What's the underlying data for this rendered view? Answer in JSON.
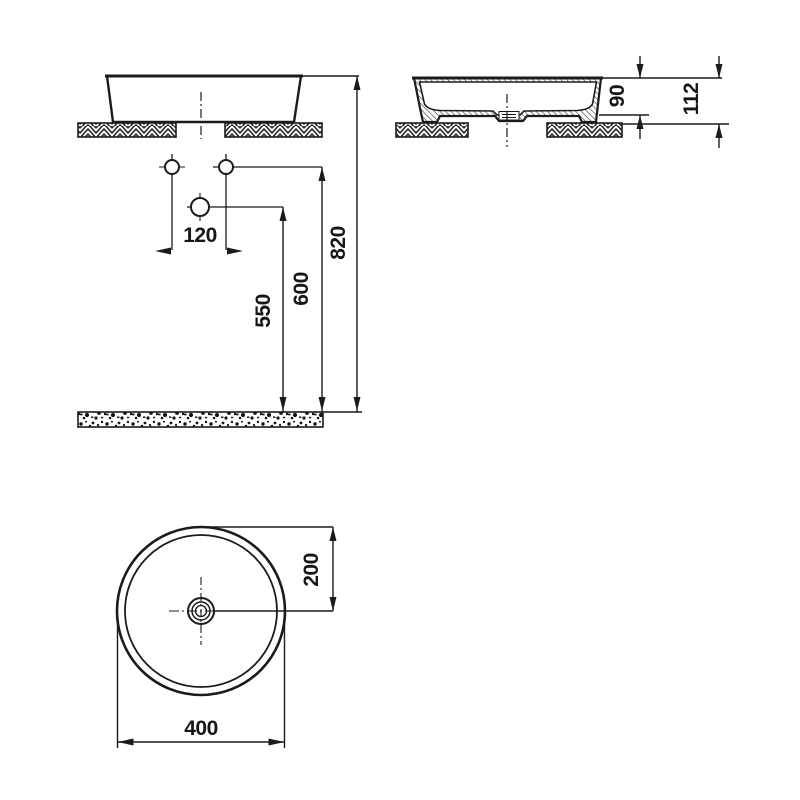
{
  "title": "Round countertop washbasin installation drawing",
  "colors": {
    "line": "#1b1b1b",
    "background": "#ffffff"
  },
  "views": {
    "front": {
      "label": "front elevation",
      "dims": {
        "hole_spacing": "120",
        "single_hole_height": "550",
        "pair_holes_height": "600",
        "rim_height": "820"
      }
    },
    "side": {
      "label": "side section",
      "dims": {
        "bowl_height": "90",
        "total_height": "112"
      }
    },
    "plan": {
      "label": "plan view",
      "dims": {
        "center_offset": "200",
        "diameter": "400"
      }
    }
  }
}
